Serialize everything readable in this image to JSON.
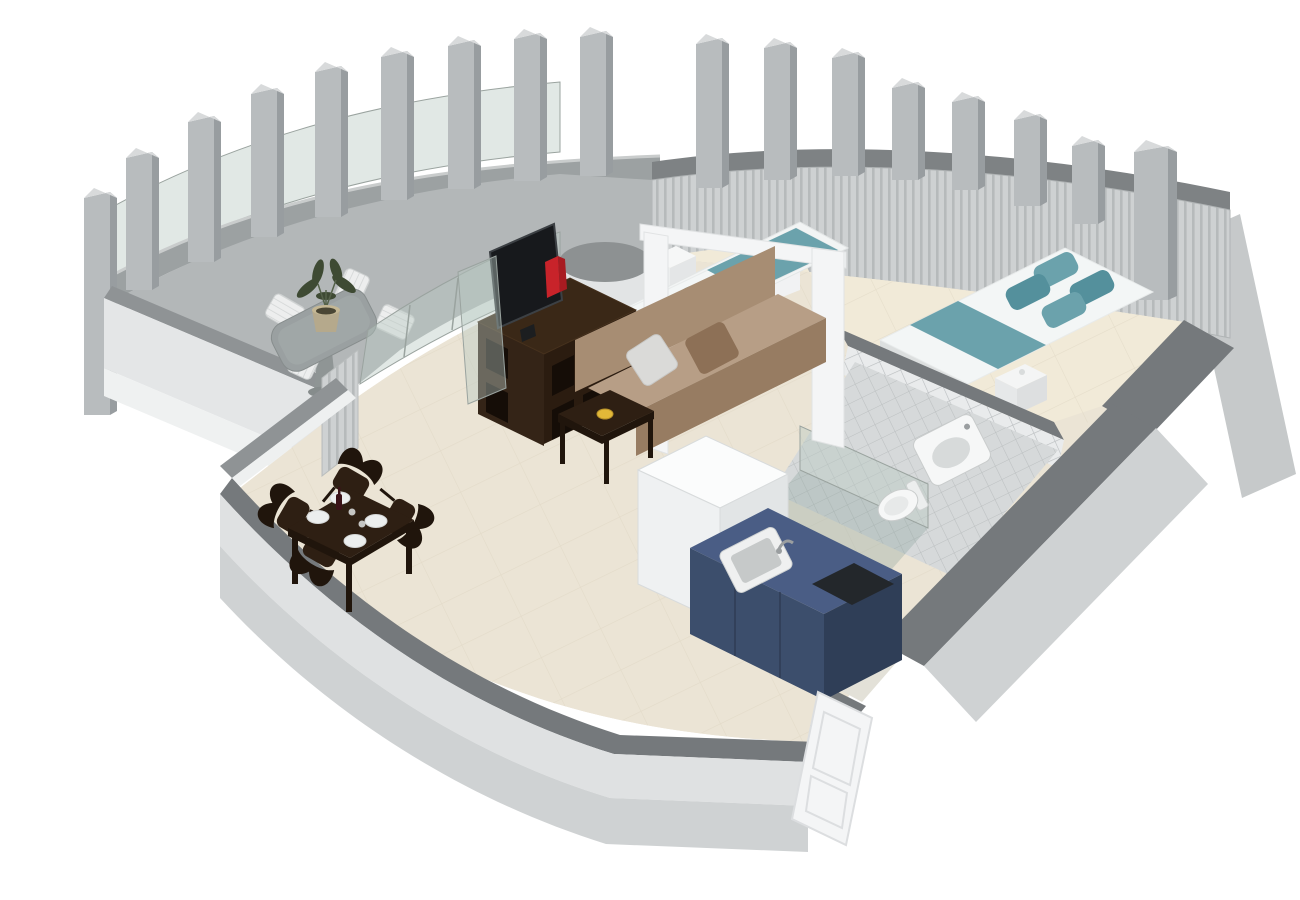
{
  "scene": {
    "type": "3d-floorplan-render",
    "rooms": [
      {
        "name": "terrace",
        "floor": "concrete",
        "items": [
          "curved-colonnade",
          "glass-balustrade",
          "parapet-wall",
          "stone-dining-table",
          "white-slatted-chairs",
          "potted-plant",
          "round-structural-column",
          "white-storage-cube"
        ]
      },
      {
        "name": "living-room",
        "floor": "beige-tile",
        "items": [
          "taupe-sofa",
          "white-cushion",
          "brown-cushion",
          "coffee-table",
          "yellow-dish",
          "tv-stand",
          "flat-screen-tv",
          "red-books",
          "glass-terrace-door",
          "sheer-curtain"
        ]
      },
      {
        "name": "dining-area",
        "floor": "beige-tile",
        "items": [
          "dark-wood-table",
          "sculpted-chairs",
          "plates",
          "wine-bottle",
          "glasses"
        ]
      },
      {
        "name": "bedroom",
        "floor": "cream",
        "items": [
          "double-bed",
          "teal-bed-runner",
          "teal-pillows",
          "single-bed",
          "teal-spread",
          "white-nightstand",
          "white-portal-frame",
          "wraparound-curtains"
        ]
      },
      {
        "name": "bathroom",
        "floor": "gray-tile",
        "items": [
          "tiled-walls",
          "wall-hung-washbasin",
          "toilet",
          "glass-shower-enclosure"
        ]
      },
      {
        "name": "kitchenette",
        "floor": "beige-tile",
        "items": [
          "navy-base-cabinets",
          "inset-sink",
          "faucet",
          "black-cooktop",
          "tall-white-unit"
        ]
      },
      {
        "name": "entrance",
        "items": [
          "white-paneled-door-open"
        ]
      }
    ],
    "counts": {
      "colonnade_pillars": 17,
      "dining_chairs": 4,
      "terrace_chairs": 4,
      "dining_plates": 4,
      "double_bed_pillows": 4,
      "beds": 2
    },
    "colors": {
      "bg": "#ffffff",
      "arc_wall": "#9ca1a2",
      "arc_wall_edge": "#c9cccc",
      "pillar_face": "#b8bcbe",
      "pillar_side": "#989da0",
      "pillar_top": "#d8dadb",
      "parapet_cap": "#8f9395",
      "parapet_face": "#e4e6e7",
      "wall_cap": "#75797c",
      "wall_face": "#dfe1e2",
      "wall_face_dark": "#cfd2d3",
      "white_paint": "#f4f5f6",
      "partition_cap": "#848889",
      "curtain": "#ced1d2",
      "curtain_stripe": "#b6babb",
      "curtain_cap": "#7e8284",
      "glass": "#b7c7c1",
      "floor_living": "#ebe4d5",
      "floor_bedroom": "#f1ead8",
      "floor_line": "#dcd3bf",
      "tile_wall": "#e9ebec",
      "tile_floor": "#d6d9da",
      "tile_line": "#b9bdbf",
      "sofa_back": "#a78d73",
      "sofa_seat": "#b79e86",
      "sofa_front": "#977c62",
      "pillow_light": "#dadad8",
      "pillow_brown": "#8d7056",
      "wood_dark": "#2e1f13",
      "wood_darker": "#20150c",
      "wood_hole": "#150d07",
      "tv_screen": "#17191c",
      "accent_red": "#c8232a",
      "accent_yellow": "#e2b838",
      "bed_white": "#f3f6f6",
      "bed_teal": "#6ba2ac",
      "bed_teal_dark": "#54909c",
      "bed_base": "#dcdfdf",
      "kitchen_top": "#4a5d85",
      "kitchen_front": "#3c4e6c",
      "kitchen_side": "#2f3e57",
      "cooktop": "#23272b",
      "fixture_white": "#f6f7f7",
      "fixture_inner": "#d7dada",
      "stone_table": "#9aa0a1",
      "plant_green": "#3e4a33",
      "pot_tan": "#b5a98c",
      "door_white": "#f4f5f6",
      "door_frame": "#dcdee0"
    }
  }
}
